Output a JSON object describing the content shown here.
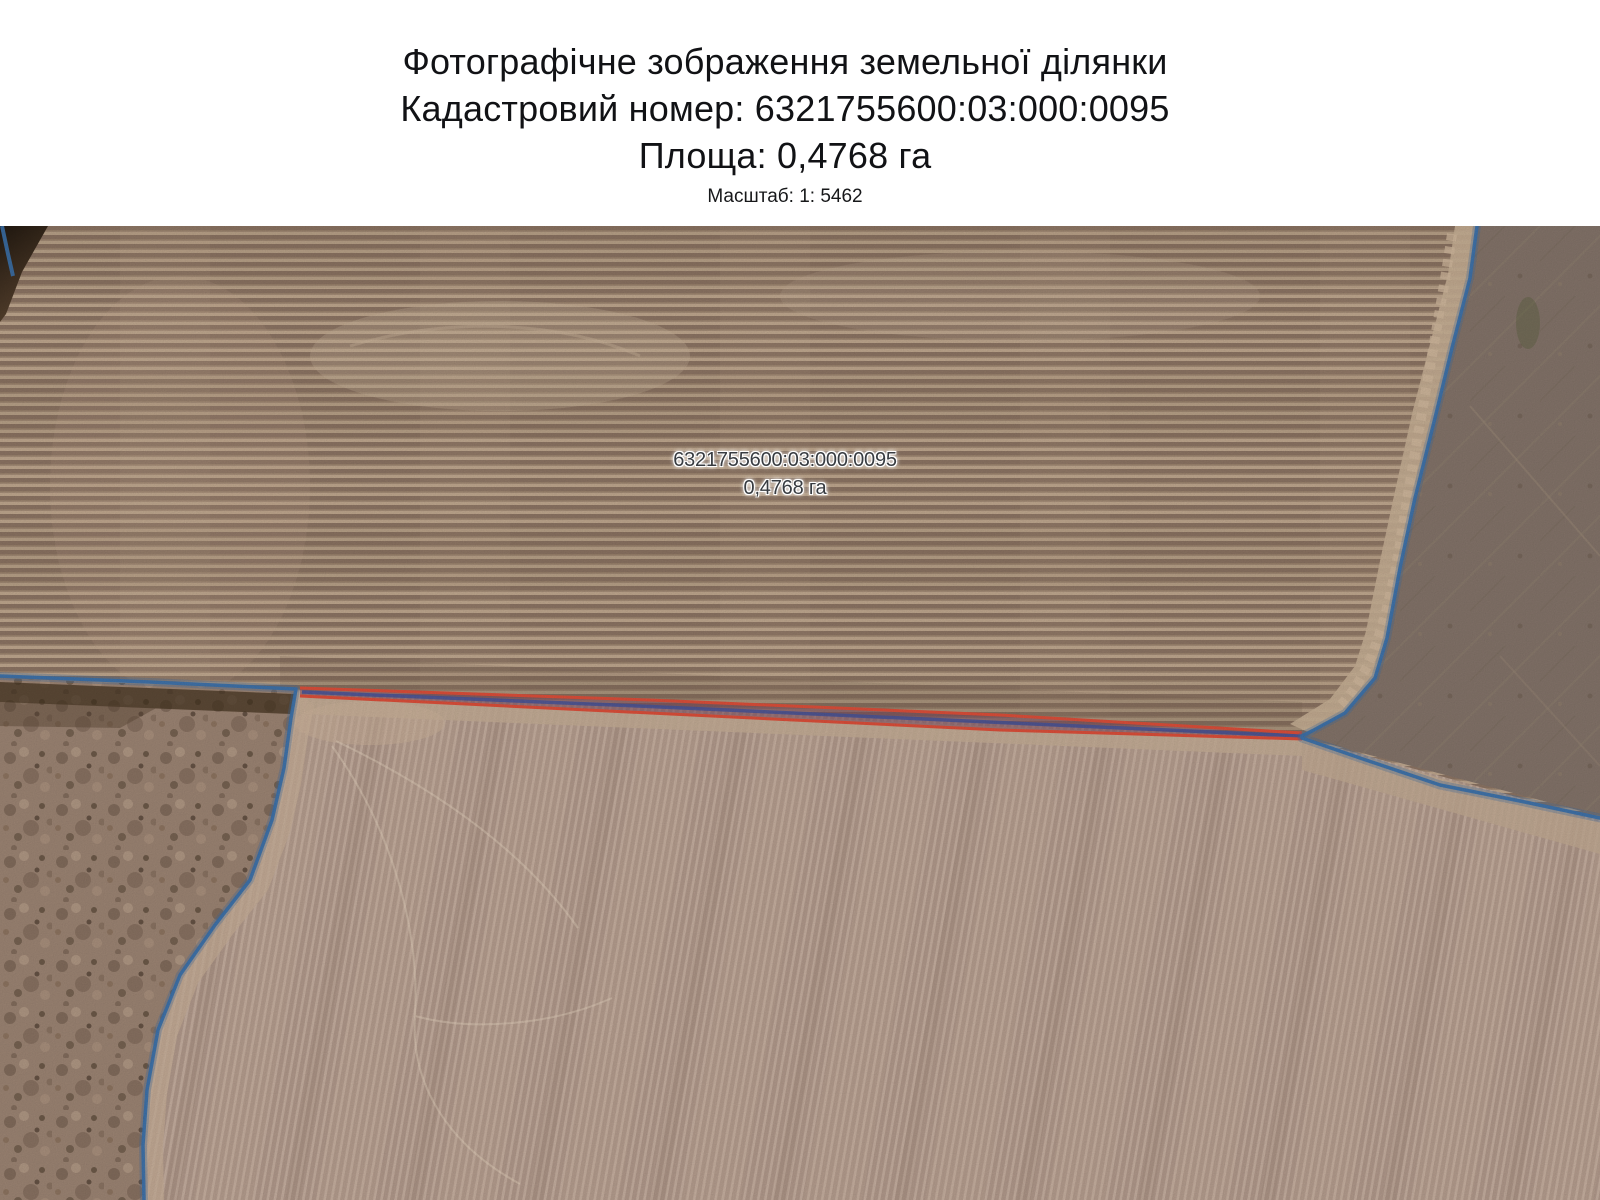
{
  "header": {
    "title": "Фотографічне зображення земельної ділянки",
    "cadastral_line": "Кадастровий номер: 6321755600:03:000:0095",
    "area_line": "Площа: 0,4768 га",
    "scale_line": "Масштаб: 1: 5462"
  },
  "map": {
    "kind": "aerial-photo-of-land-parcel",
    "parcel_label": {
      "cadastral_number": "6321755600:03:000:0095",
      "area": "0,4768 га"
    },
    "colors": {
      "parcel_outline_red": "#dd4f3a",
      "parcel_fill_dark": "#7c4a60",
      "parcel_inner_blue": "#47549a",
      "boundary_blue": "#3c72ac",
      "label_text": "#383c41"
    }
  }
}
